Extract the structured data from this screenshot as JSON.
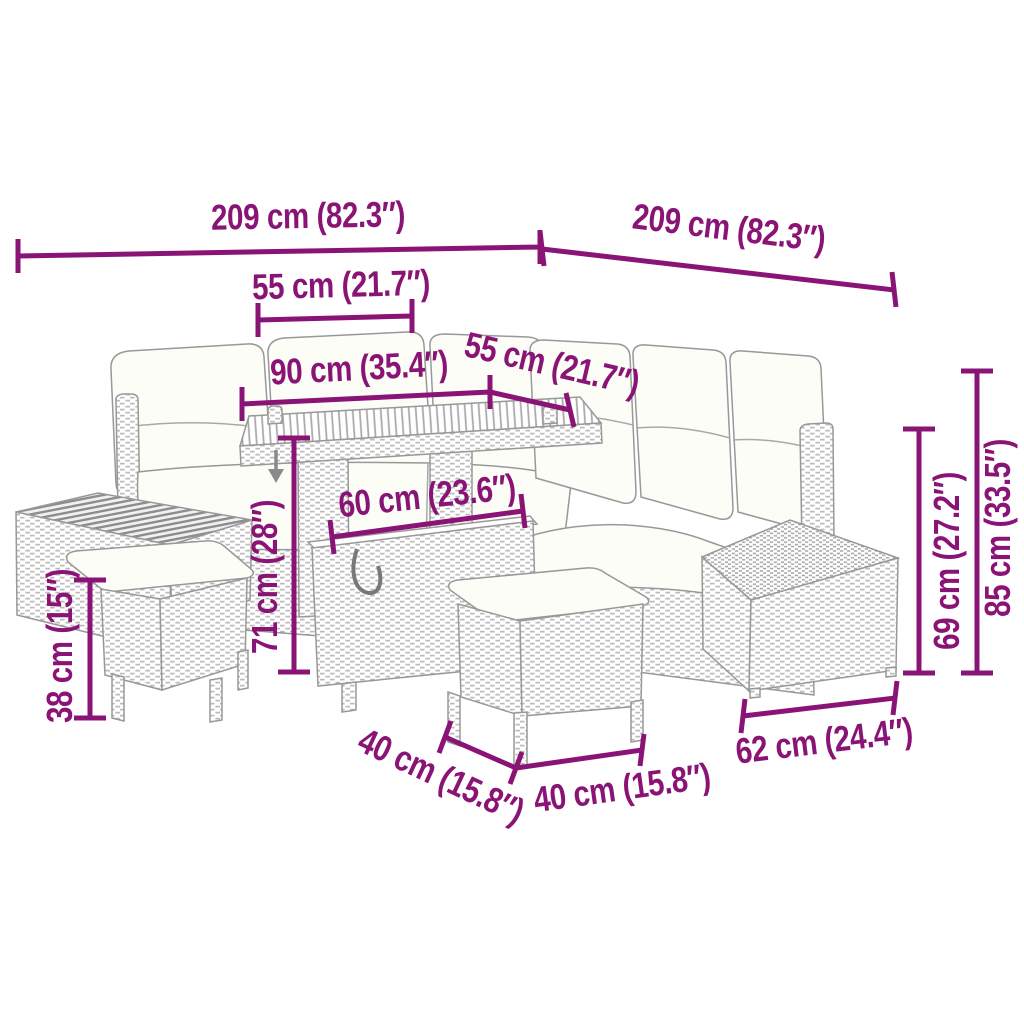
{
  "colors": {
    "dimension_accent": "#8A1476",
    "drawing_line": "#989898"
  },
  "icons": {
    "height_adjust_indicator": "down-arrow-icon"
  },
  "dimensions": [
    {
      "id": "overall-width-left",
      "label": "209 cm (82.3″)"
    },
    {
      "id": "overall-width-right",
      "label": "209 cm (82.3″)"
    },
    {
      "id": "seat-depth-top",
      "label": "55 cm (21.7″)"
    },
    {
      "id": "corner-section-width",
      "label": "90 cm (35.4″)"
    },
    {
      "id": "seat-width-right",
      "label": "55 cm (21.7″)"
    },
    {
      "id": "table-top-length",
      "label": "60 cm (23.6″)"
    },
    {
      "id": "table-height",
      "label": "71 cm (28″)"
    },
    {
      "id": "stool-height",
      "label": "38 cm (15″)"
    },
    {
      "id": "seat-back-height",
      "label": "69 cm (27.2″)"
    },
    {
      "id": "overall-height",
      "label": "85 cm (33.5″)"
    },
    {
      "id": "stool-depth",
      "label": "40 cm (15.8″)"
    },
    {
      "id": "stool-width",
      "label": "40 cm (15.8″)"
    },
    {
      "id": "side-table-width",
      "label": "62 cm (24.4″)"
    }
  ]
}
